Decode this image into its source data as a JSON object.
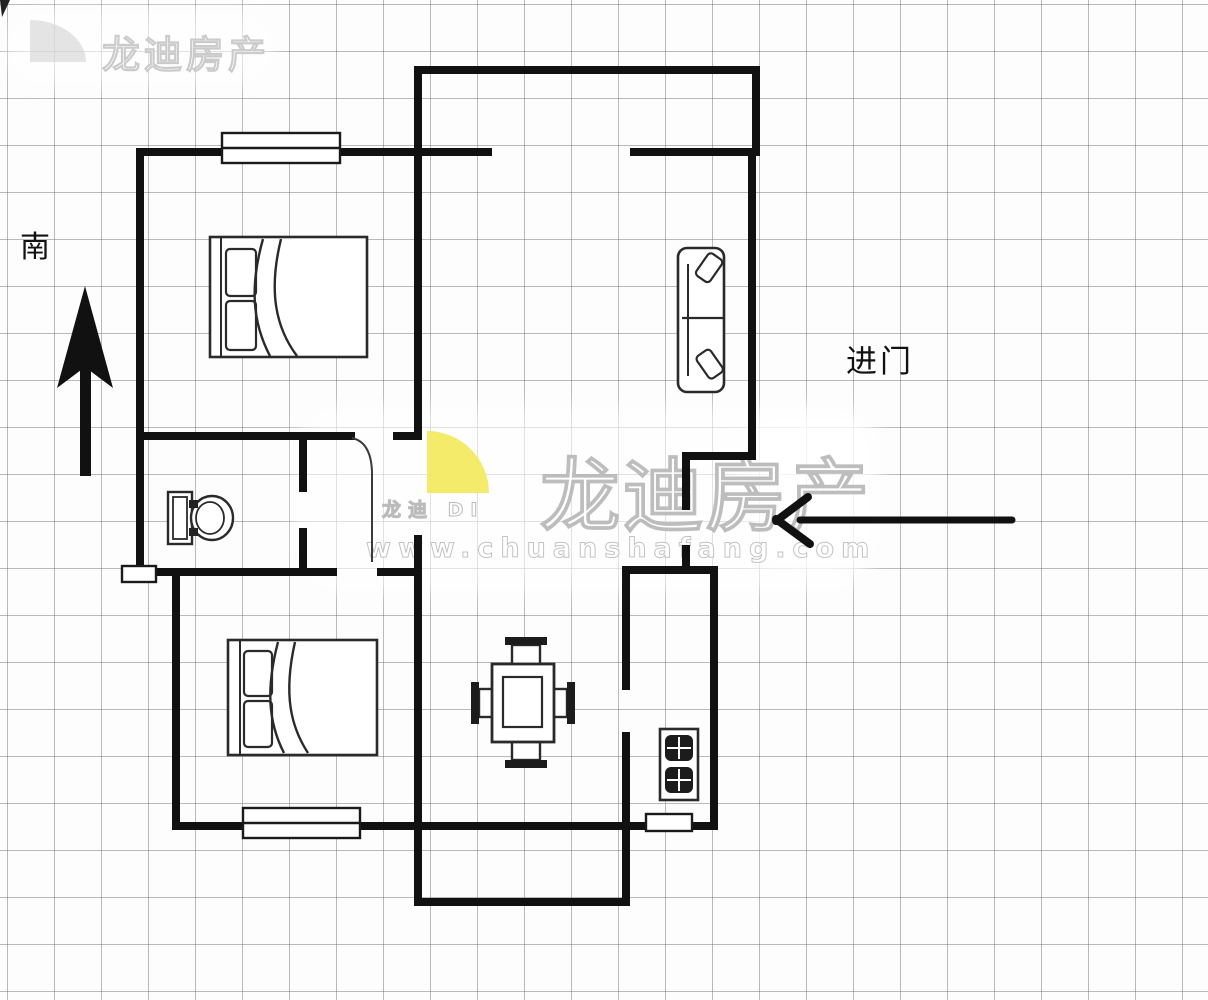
{
  "canvas": {
    "width": 1208,
    "height": 1000,
    "background": "#fdfdfd",
    "grid_color": "#828282",
    "grid_cell_px": 47
  },
  "colors": {
    "wall_ink": "#111111",
    "furniture_ink": "#2a2a2a",
    "logo_yellow": "#f2e95c",
    "watermark_gray": "#c8c8c8"
  },
  "labels": {
    "south": "南",
    "entrance": "进门"
  },
  "watermark": {
    "corner": {
      "company": "龙迪房产"
    },
    "center": {
      "company": "龙迪房产",
      "logo_caption": "龙迪 DI",
      "url": "www.chuanshafang.com"
    }
  },
  "icons": [
    "south-direction-arrow",
    "entrance-direction-arrow",
    "double-bed-icon",
    "sofa-icon",
    "toilet-icon",
    "dining-table-icon",
    "stove-icon",
    "window-symbol",
    "door-arc-symbol",
    "brand-logo-quarter-disc"
  ]
}
